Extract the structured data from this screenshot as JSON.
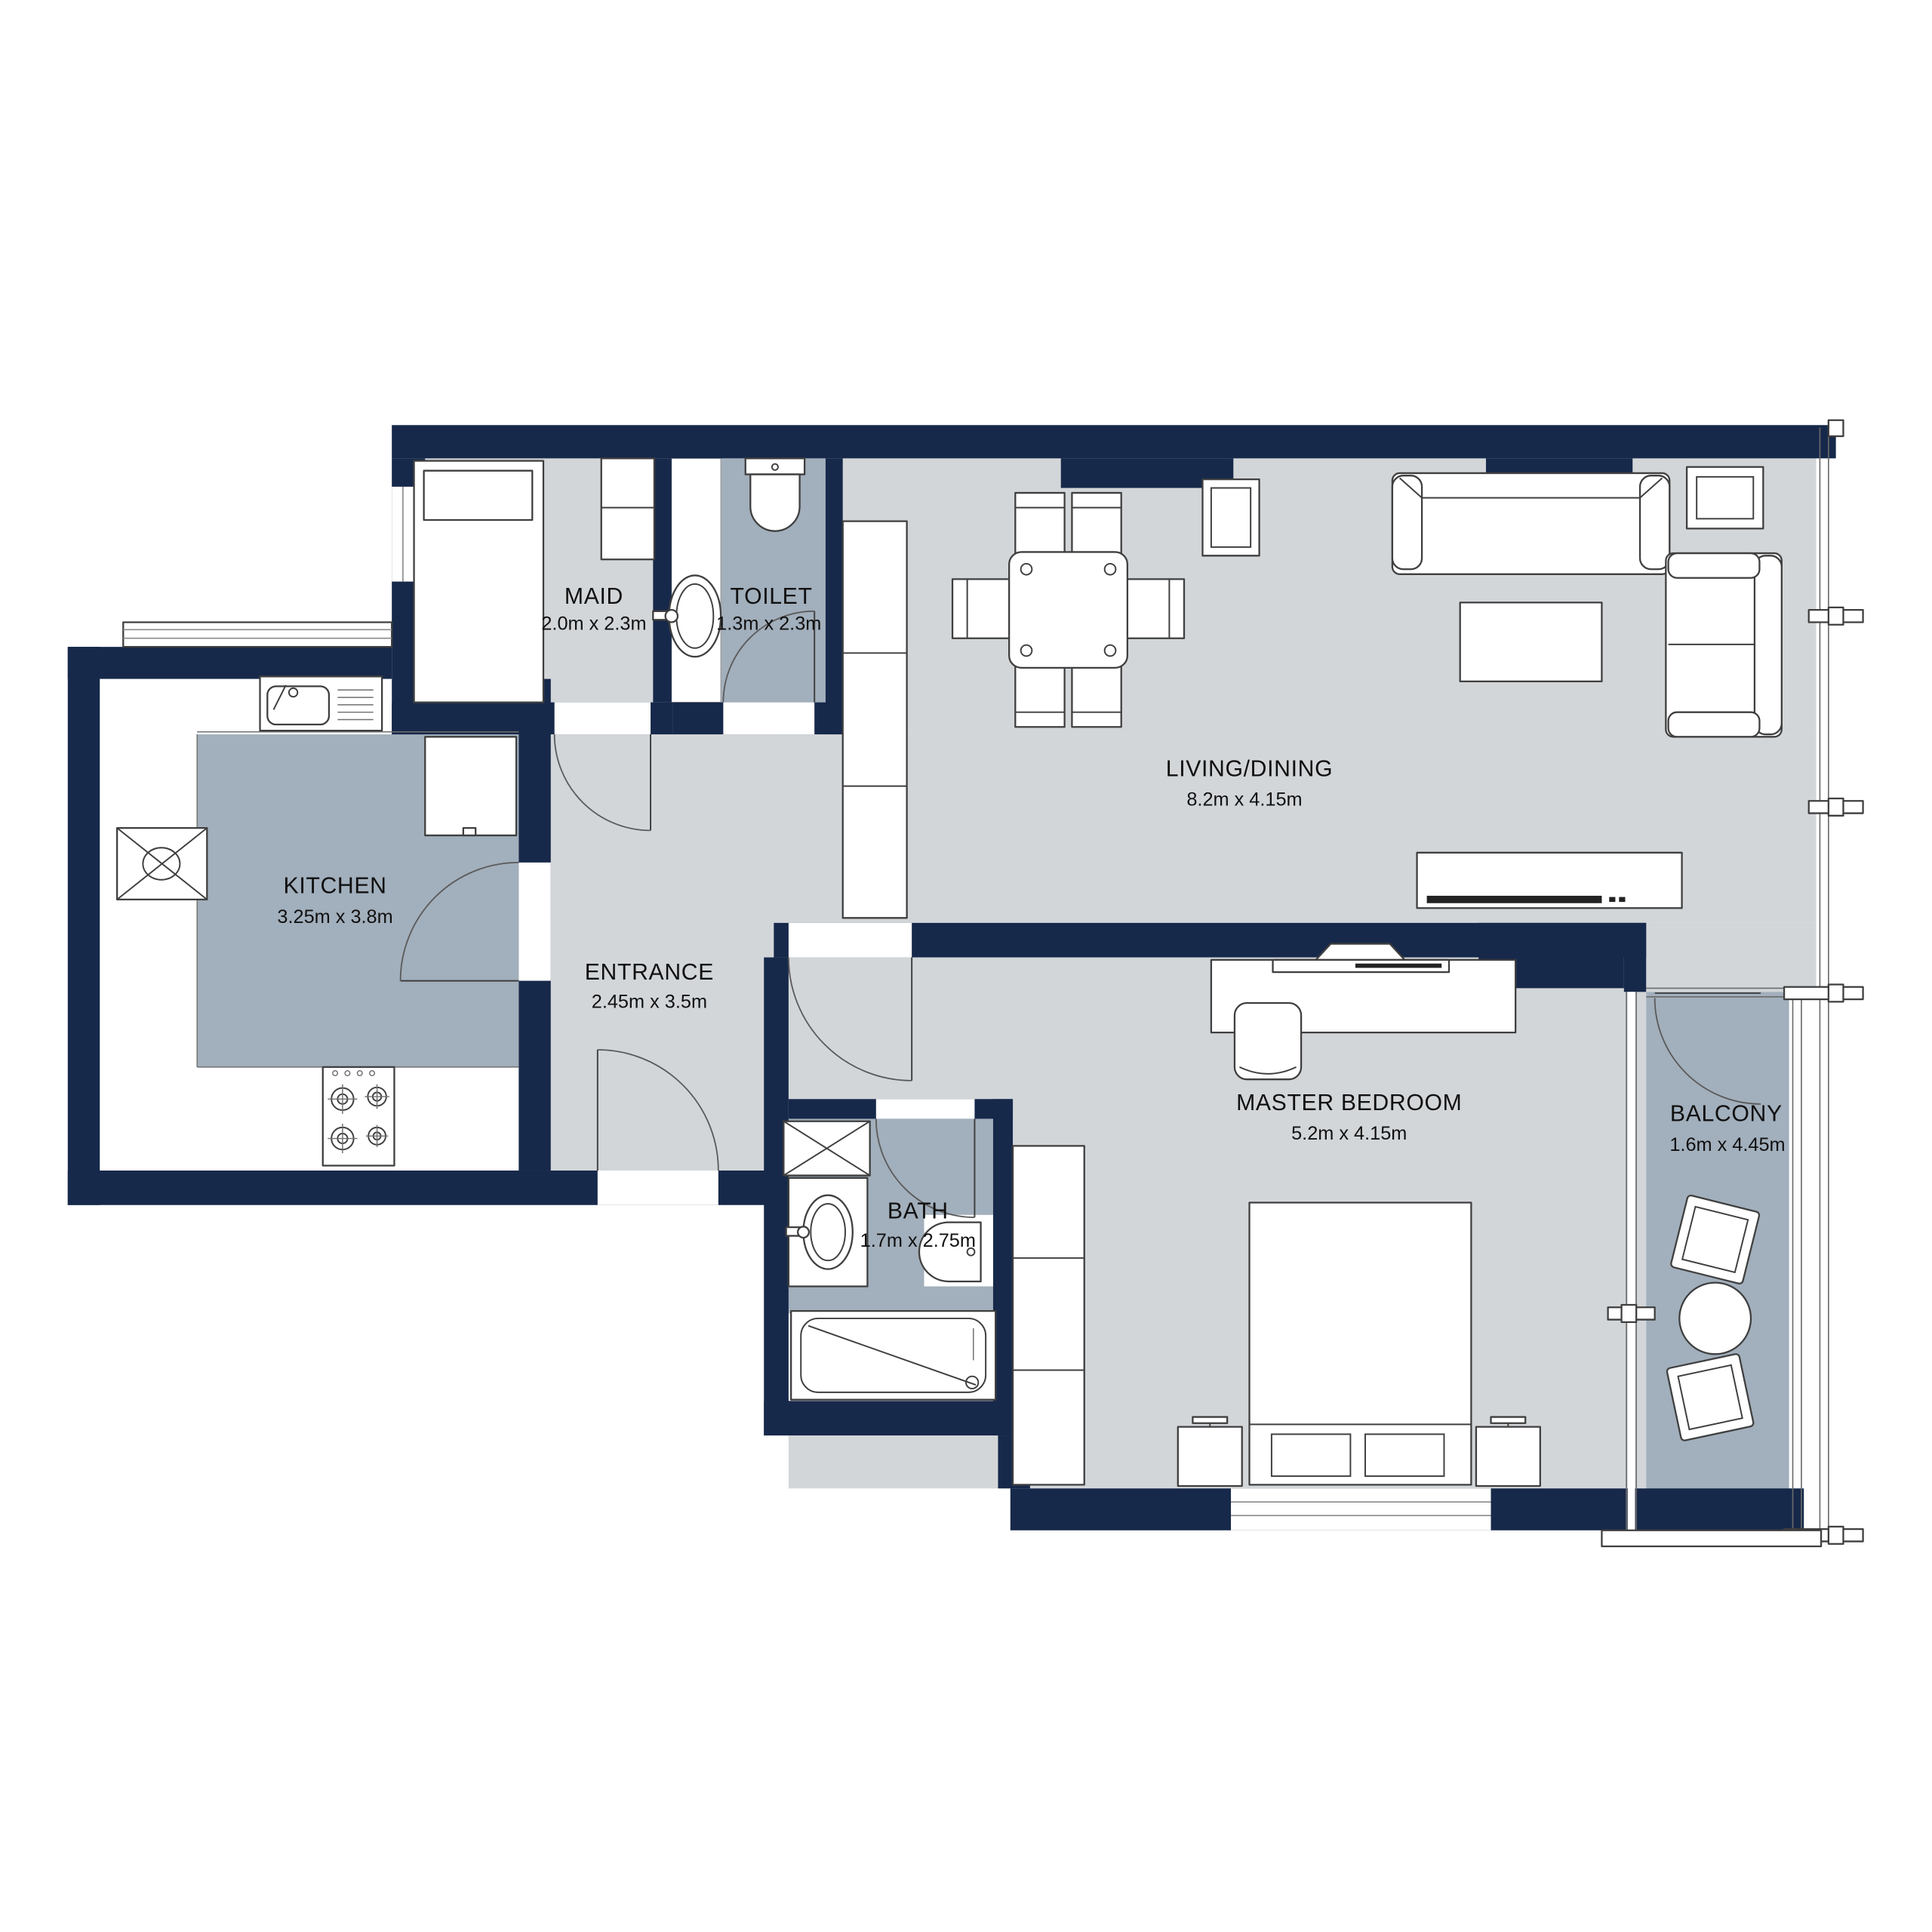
{
  "title": "Apartment Floor Plan",
  "colors": {
    "wall": "#17294a",
    "floor_light": "#d3d6d9",
    "floor_shaded": "#a2afbc",
    "furniture_outline": "#3f3f3f",
    "label_text": "#101010"
  },
  "rooms": [
    {
      "id": "maid",
      "name": "MAID",
      "dims": "2.0m x 2.3m"
    },
    {
      "id": "toilet",
      "name": "TOILET",
      "dims": "1.3m x 2.3m"
    },
    {
      "id": "kitchen",
      "name": "KITCHEN",
      "dims": "3.25m x 3.8m"
    },
    {
      "id": "entrance",
      "name": "ENTRANCE",
      "dims": "2.45m x 3.5m"
    },
    {
      "id": "living_dining",
      "name": "LIVING/DINING",
      "dims": "8.2m x 4.15m"
    },
    {
      "id": "master_bedroom",
      "name": "MASTER BEDROOM",
      "dims": "5.2m x 4.15m"
    },
    {
      "id": "bath",
      "name": "BATH",
      "dims": "1.7m x 2.75m"
    },
    {
      "id": "balcony",
      "name": "BALCONY",
      "dims": "1.6m x 4.45m"
    }
  ],
  "fixtures": [
    "single-bed",
    "closet",
    "wc-toilet",
    "wash-basin",
    "vanity-counter",
    "kitchen-sink",
    "refrigerator",
    "gas-stove",
    "service-shaft",
    "dining-table-six-chairs",
    "three-seat-sofa",
    "two-seat-armchair",
    "coffee-table",
    "side-table",
    "tv-console",
    "tall-cabinet",
    "double-bed",
    "nightstand",
    "dresser-with-tv",
    "desk-chair",
    "bathtub",
    "wardrobe",
    "balcony-chair",
    "balcony-round-table",
    "glass-railing",
    "entry-door",
    "interior-door",
    "window"
  ]
}
